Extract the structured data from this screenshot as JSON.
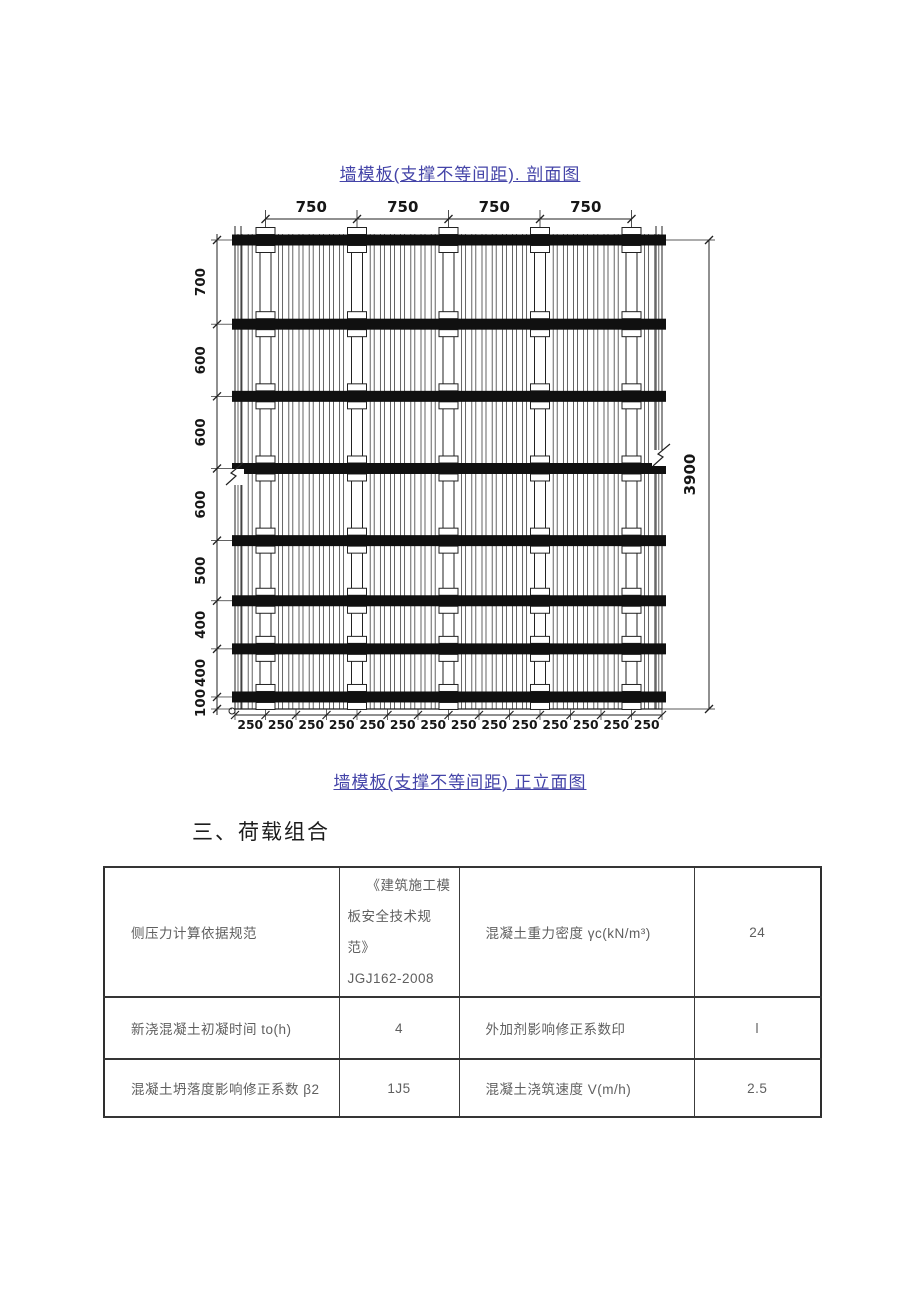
{
  "captions": {
    "top": "墙模板(支撑不等间距). 剖面图",
    "bottom": "墙模板(支撑不等间距) 正立面图"
  },
  "section_heading": "三、荷载组合",
  "diagram": {
    "top_dims": [
      "750",
      "750",
      "750",
      "750"
    ],
    "left_dims": [
      "700",
      "600",
      "600",
      "600",
      "500",
      "400",
      "400",
      "100"
    ],
    "right_dim": "3900",
    "bottom_dims": [
      "250",
      "250",
      "250",
      "250",
      "250",
      "250",
      "250",
      "250",
      "250",
      "250",
      "250",
      "250",
      "250",
      "250"
    ],
    "waler_count": 8,
    "tie_count": 5,
    "line_color": "#222222",
    "waler_color": "#101010"
  },
  "load_table": {
    "rows": [
      {
        "c1": "侧压力计算依据规范",
        "c2_lines": [
          "《建筑施工模",
          "板安全技术规范》",
          "JGJ162-2008"
        ],
        "c3": "混凝土重力密度 γc(kN/m³)",
        "c4": "24"
      },
      {
        "c1": "新浇混凝土初凝时间 to(h)",
        "c2": "4",
        "c3": "外加剂影响修正系数印",
        "c4": "l"
      },
      {
        "c1": "混凝土坍落度影响修正系数 β2",
        "c2": "1J5",
        "c3": "混凝土浇筑速度 V(m/h)",
        "c4": "2.5"
      }
    ]
  }
}
